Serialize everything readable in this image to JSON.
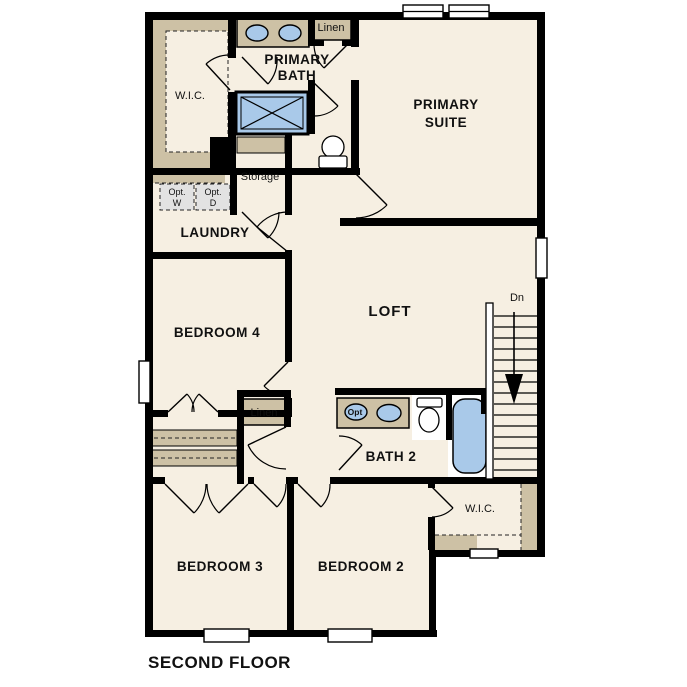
{
  "plan": {
    "title": "SECOND FLOOR",
    "colors": {
      "floor": "#f6efe2",
      "wall": "#000000",
      "shelf_tan": "#cdc1a5",
      "fixture_blue": "#a9c9e9",
      "appliance_gray": "#e2e2e2",
      "background": "#ffffff"
    },
    "labels": {
      "wic_primary": "W.I.C.",
      "primary_bath_line1": "PRIMARY",
      "primary_bath_line2": "BATH",
      "linen_upper": "Linen",
      "primary_suite_line1": "PRIMARY",
      "primary_suite_line2": "SUITE",
      "storage": "Storage",
      "laundry": "LAUNDRY",
      "opt_w_line1": "Opt.",
      "opt_w_line2": "W",
      "opt_d_line1": "Opt.",
      "opt_d_line2": "D",
      "bedroom4": "BEDROOM 4",
      "loft": "LOFT",
      "stairs_down": "Dn",
      "linen_lower": "Linen",
      "opt_sink": "Opt",
      "bath2": "BATH 2",
      "wic_bedroom2": "W.I.C.",
      "bedroom3": "BEDROOM 3",
      "bedroom2": "BEDROOM 2"
    }
  }
}
